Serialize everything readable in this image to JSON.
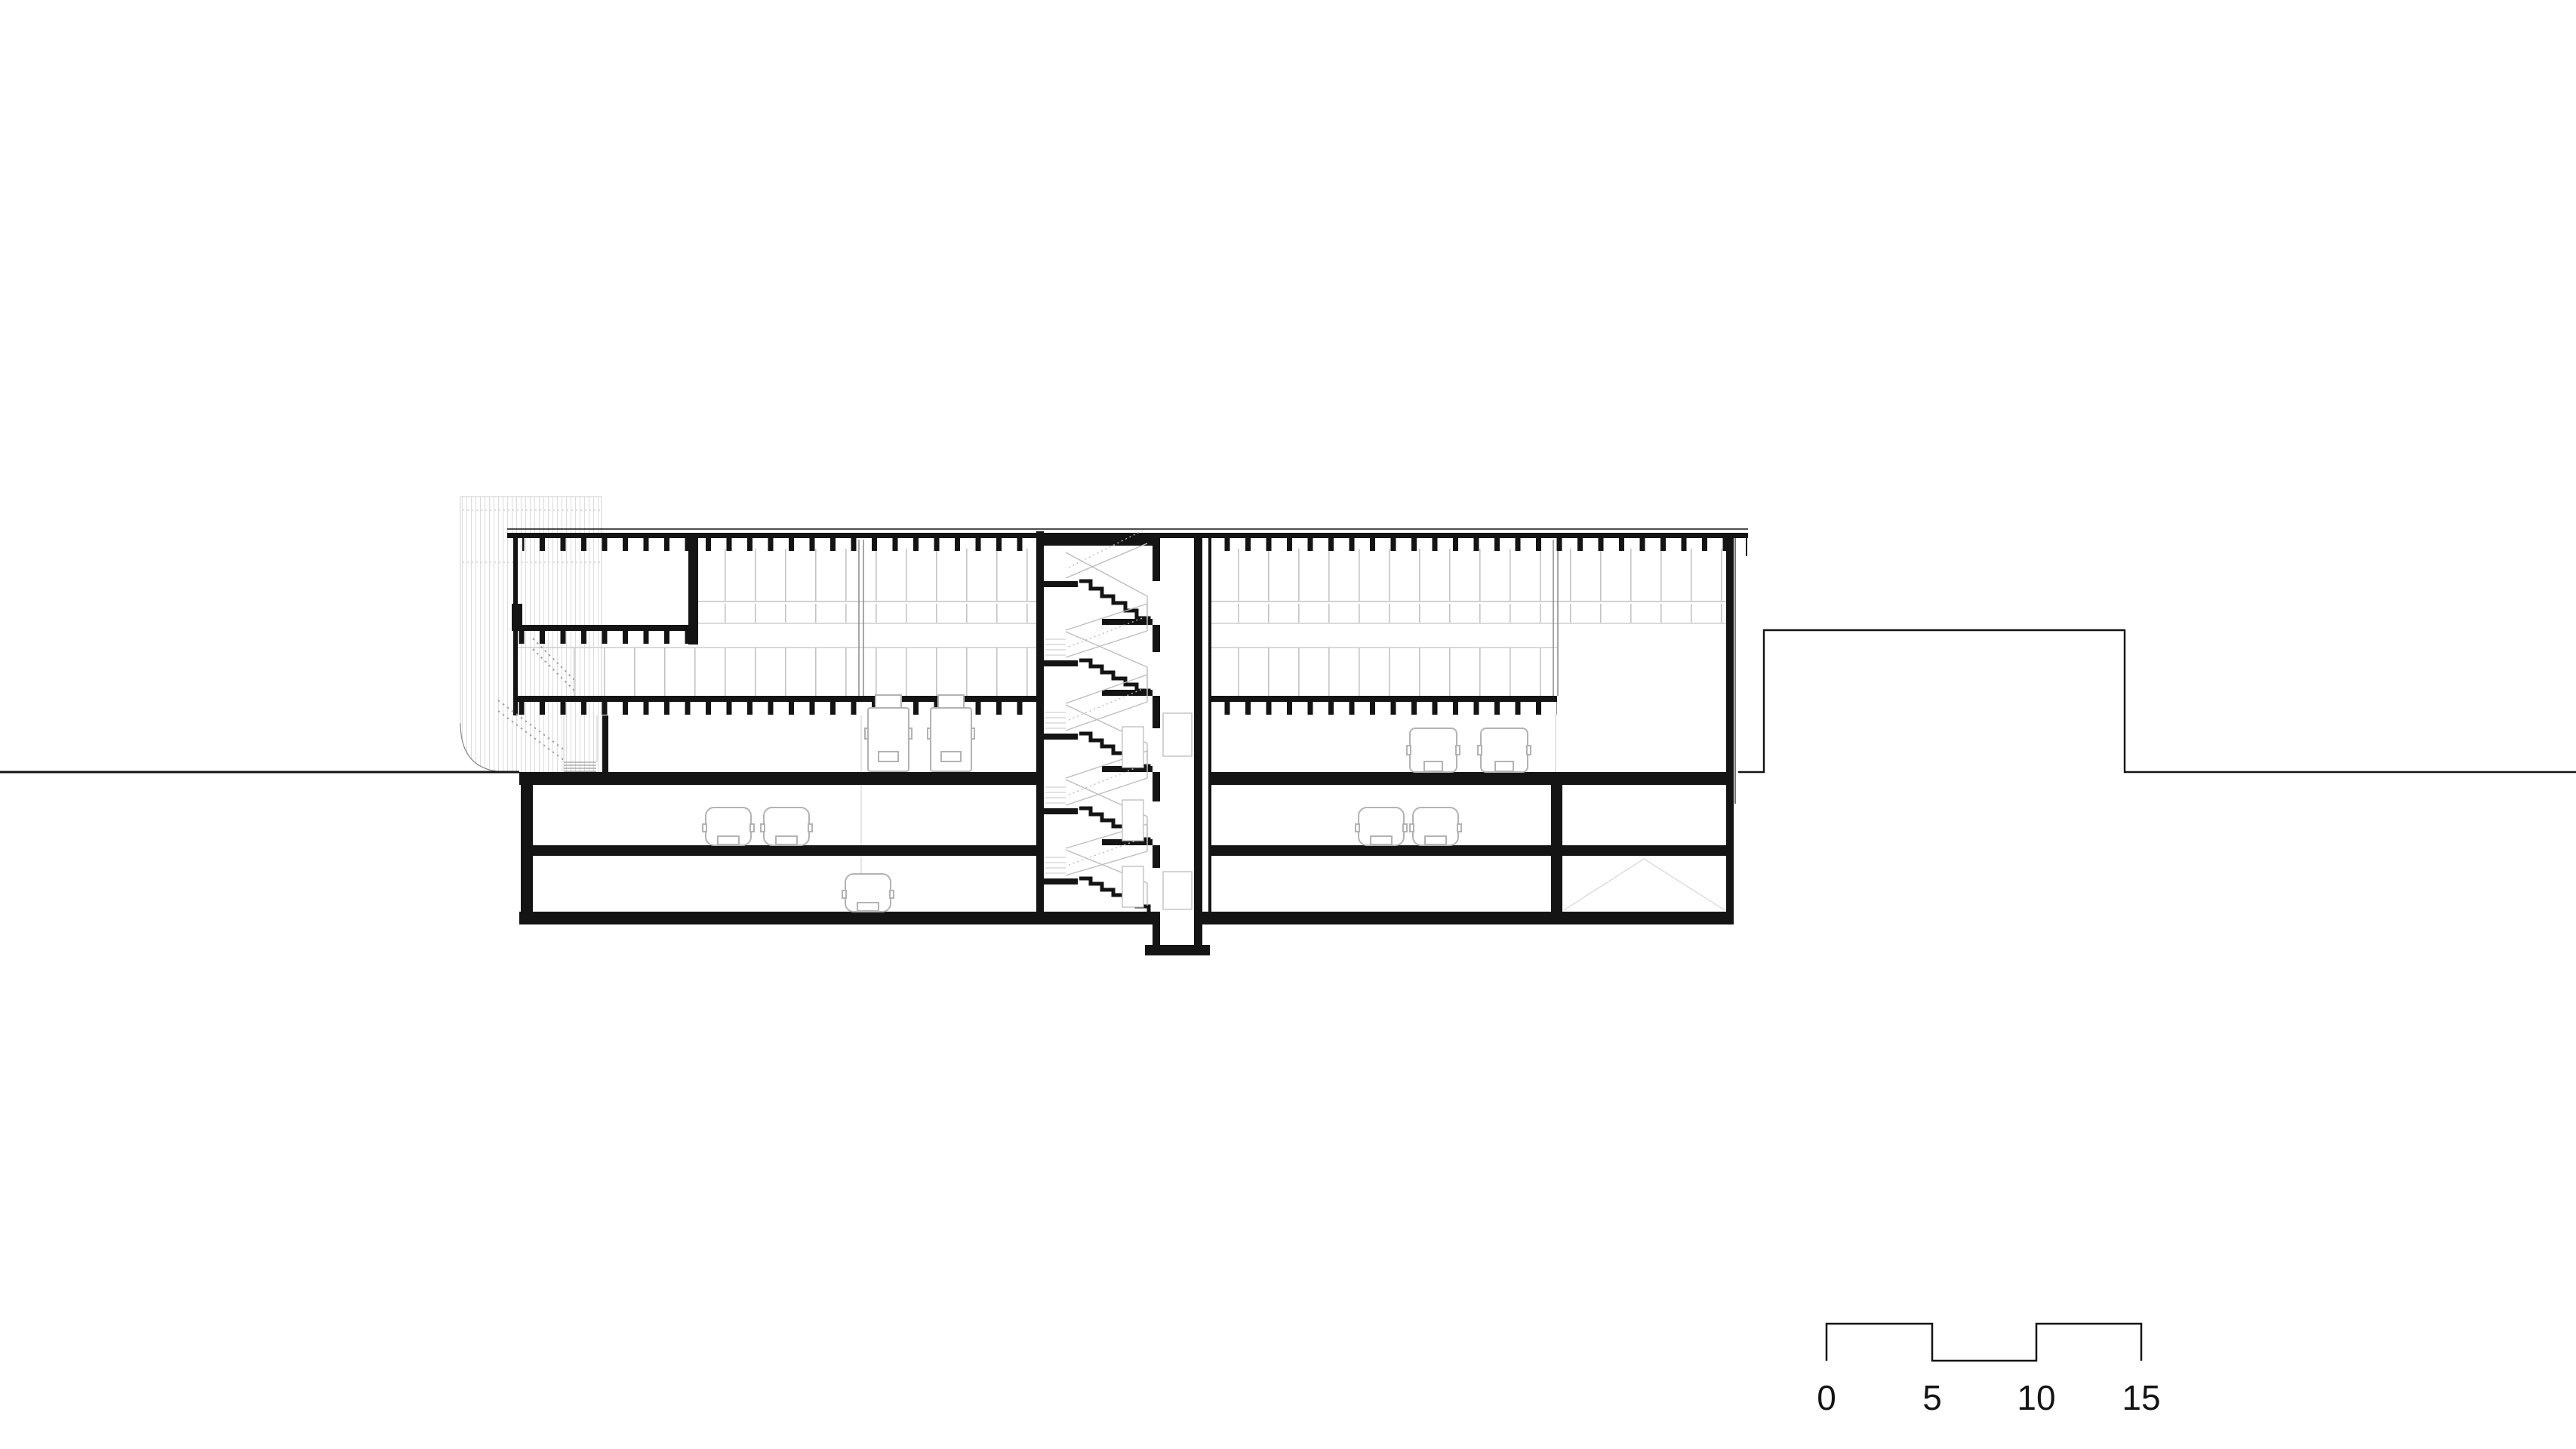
{
  "page": {
    "kind": "architectural-section-drawing",
    "background": "#ffffff"
  },
  "colors": {
    "ink": "#141414",
    "line_light": "#c4c4c4",
    "line_faint": "#dedede",
    "vehicle": "#b3b3b3",
    "hatch": "#dcdcdc",
    "dash": "#9e9e9e",
    "bg": "#ffffff"
  },
  "scale_bar": {
    "labels": [
      "0",
      "5",
      "10",
      "15"
    ]
  },
  "section": {
    "levels": [
      {
        "name": "roof"
      },
      {
        "name": "upper-floor"
      },
      {
        "name": "lower-floor"
      },
      {
        "name": "ground-floor"
      },
      {
        "name": "basement-1"
      },
      {
        "name": "basement-2"
      }
    ],
    "features": {
      "stair_flights": 5,
      "elevator_shafts": 1,
      "ground_floor_trucks": 2,
      "ground_floor_vans": 2,
      "basement1_cars": 4,
      "basement2_cars": 1
    }
  }
}
